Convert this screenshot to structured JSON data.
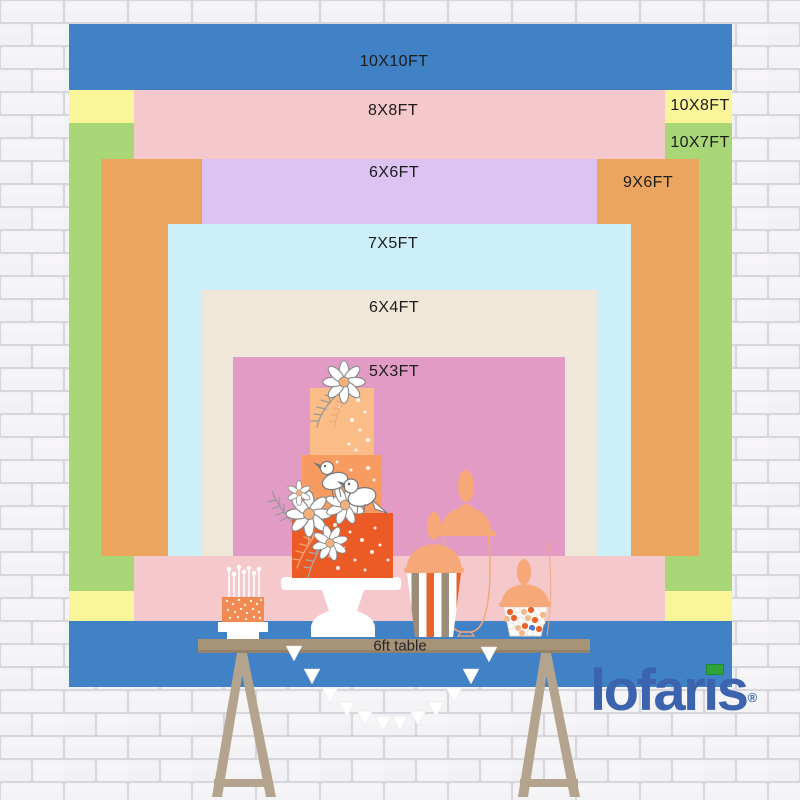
{
  "page": {
    "title": "Backdrop size chart with dessert table",
    "width": 800,
    "height": 800
  },
  "backdrop": {
    "sizes": [
      {
        "id": "10x10",
        "label": "10X10FT",
        "color": "#4181C5",
        "rect": {
          "x": 69,
          "y": 24,
          "w": 663,
          "h": 663
        },
        "label_at": {
          "x": 394,
          "y": 62
        }
      },
      {
        "id": "10x8",
        "label": "10X8FT",
        "color": "#FAF598",
        "rect": {
          "x": 69,
          "y": 90,
          "w": 663,
          "h": 531
        },
        "label_at": {
          "x": 700,
          "y": 106
        }
      },
      {
        "id": "10x7",
        "label": "10X7FT",
        "color": "#A9D777",
        "rect": {
          "x": 69,
          "y": 123,
          "w": 663,
          "h": 468
        },
        "label_at": {
          "x": 700,
          "y": 143
        }
      },
      {
        "id": "8x8",
        "label": "8X8FT",
        "color": "#F5C8CC",
        "rect": {
          "x": 134,
          "y": 90,
          "w": 531,
          "h": 531
        },
        "label_at": {
          "x": 393,
          "y": 111
        }
      },
      {
        "id": "9x6",
        "label": "9X6FT",
        "color": "#ECA55F",
        "rect": {
          "x": 101,
          "y": 159,
          "w": 598,
          "h": 397
        },
        "label_at": {
          "x": 648,
          "y": 183
        }
      },
      {
        "id": "6x6",
        "label": "6X6FT",
        "color": "#DCC3F1",
        "rect": {
          "x": 202,
          "y": 159,
          "w": 395,
          "h": 397
        },
        "label_at": {
          "x": 394,
          "y": 173
        }
      },
      {
        "id": "7x5",
        "label": "7X5FT",
        "color": "#CCEFFA",
        "rect": {
          "x": 168,
          "y": 224,
          "w": 463,
          "h": 332
        },
        "label_at": {
          "x": 393,
          "y": 244
        }
      },
      {
        "id": "6x4",
        "label": "6X4FT",
        "color": "#EFE8D9",
        "rect": {
          "x": 202,
          "y": 290,
          "w": 395,
          "h": 266
        },
        "label_at": {
          "x": 394,
          "y": 308
        }
      },
      {
        "id": "5x3",
        "label": "5X3FT",
        "color": "#E29BC5",
        "rect": {
          "x": 233,
          "y": 357,
          "w": 332,
          "h": 199
        },
        "label_at": {
          "x": 394,
          "y": 372
        }
      }
    ]
  },
  "table": {
    "label": "6ft table"
  },
  "logo": {
    "text": "lofaris",
    "registered": "®"
  },
  "palette": {
    "logoBlue": "#3B63AE",
    "logoGreen": "#2EA43B",
    "cakeTop": "#FBBD87",
    "cakeMid": "#F89B60",
    "cakeBottom": "#EC5A26",
    "smallCake": "#F08A52",
    "peachLid": "#F7A878",
    "jarOutline": "#F2A876",
    "stripeOrange": "#E8632C",
    "stripeTan": "#9C8D78",
    "candyPeach": "#F4B98A",
    "candyBlue": "#4A7AC8",
    "tableTop": "#A69378",
    "tableEdge": "#93826B",
    "leg": "#B5A48D",
    "flowerCenter": "#F2B07C",
    "outlineGray": "#8A8A8A",
    "buntingWhite": "#FFFFFF",
    "mortar": "#D7D6DD",
    "brickFace": "#F3F2F5"
  }
}
